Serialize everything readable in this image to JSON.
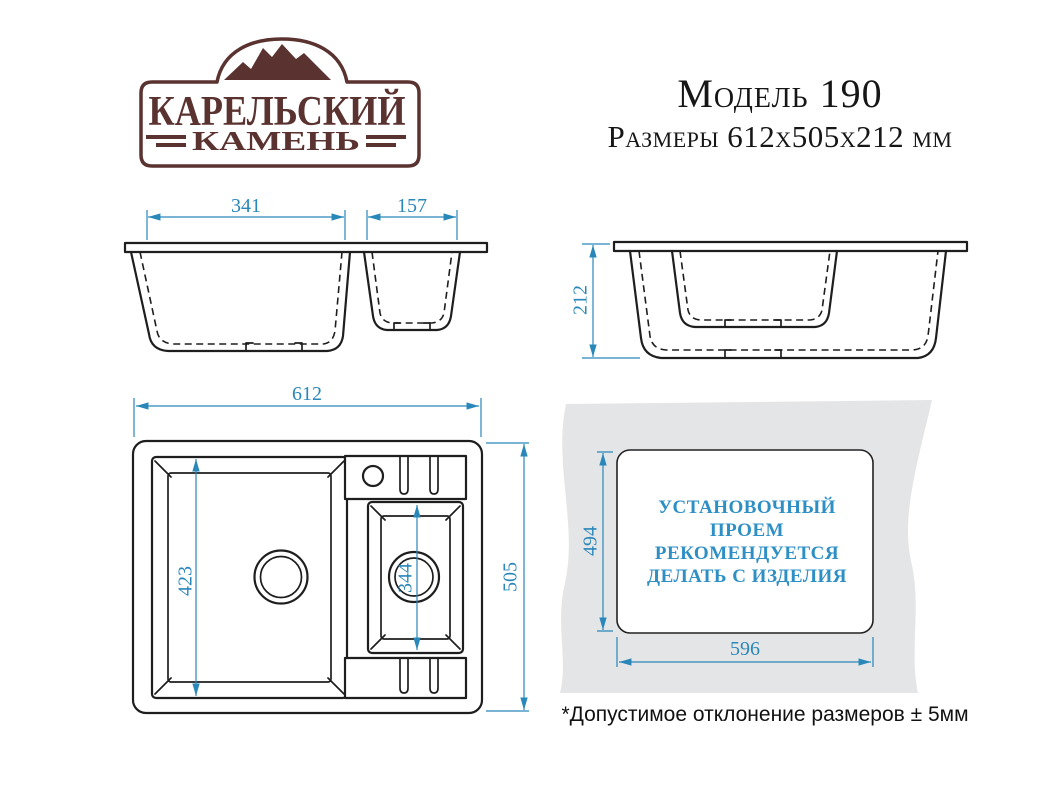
{
  "brand": {
    "name_line1": "КАРЕЛЬСКИЙ",
    "name_line2": "КАМЕНЬ"
  },
  "header": {
    "model": "Модель 190",
    "dimensions": "Размеры 612x505x212 мм"
  },
  "front_view": {
    "large_bowl_width": "341",
    "small_bowl_width": "157"
  },
  "side_view": {
    "height": "212"
  },
  "top_view": {
    "overall_width": "612",
    "overall_depth": "505",
    "large_bowl_length": "423",
    "small_bowl_length": "344"
  },
  "cutout": {
    "height": "494",
    "width": "596",
    "note_lines": [
      "УСТАНОВОЧНЫЙ",
      "ПРОЕМ",
      "РЕКОМЕНДУЕТСЯ",
      "ДЕЛАТЬ С ИЗДЕЛИЯ"
    ]
  },
  "footnote": "*Допустимое отклонение размеров ± 5мм",
  "colors": {
    "dimension_blue": "#2987ba",
    "note_blue": "#2e8fc5",
    "brand_maroon": "#5a3331",
    "line_black": "#1e1e1e",
    "countertop_gray": "#e4e5e7"
  }
}
